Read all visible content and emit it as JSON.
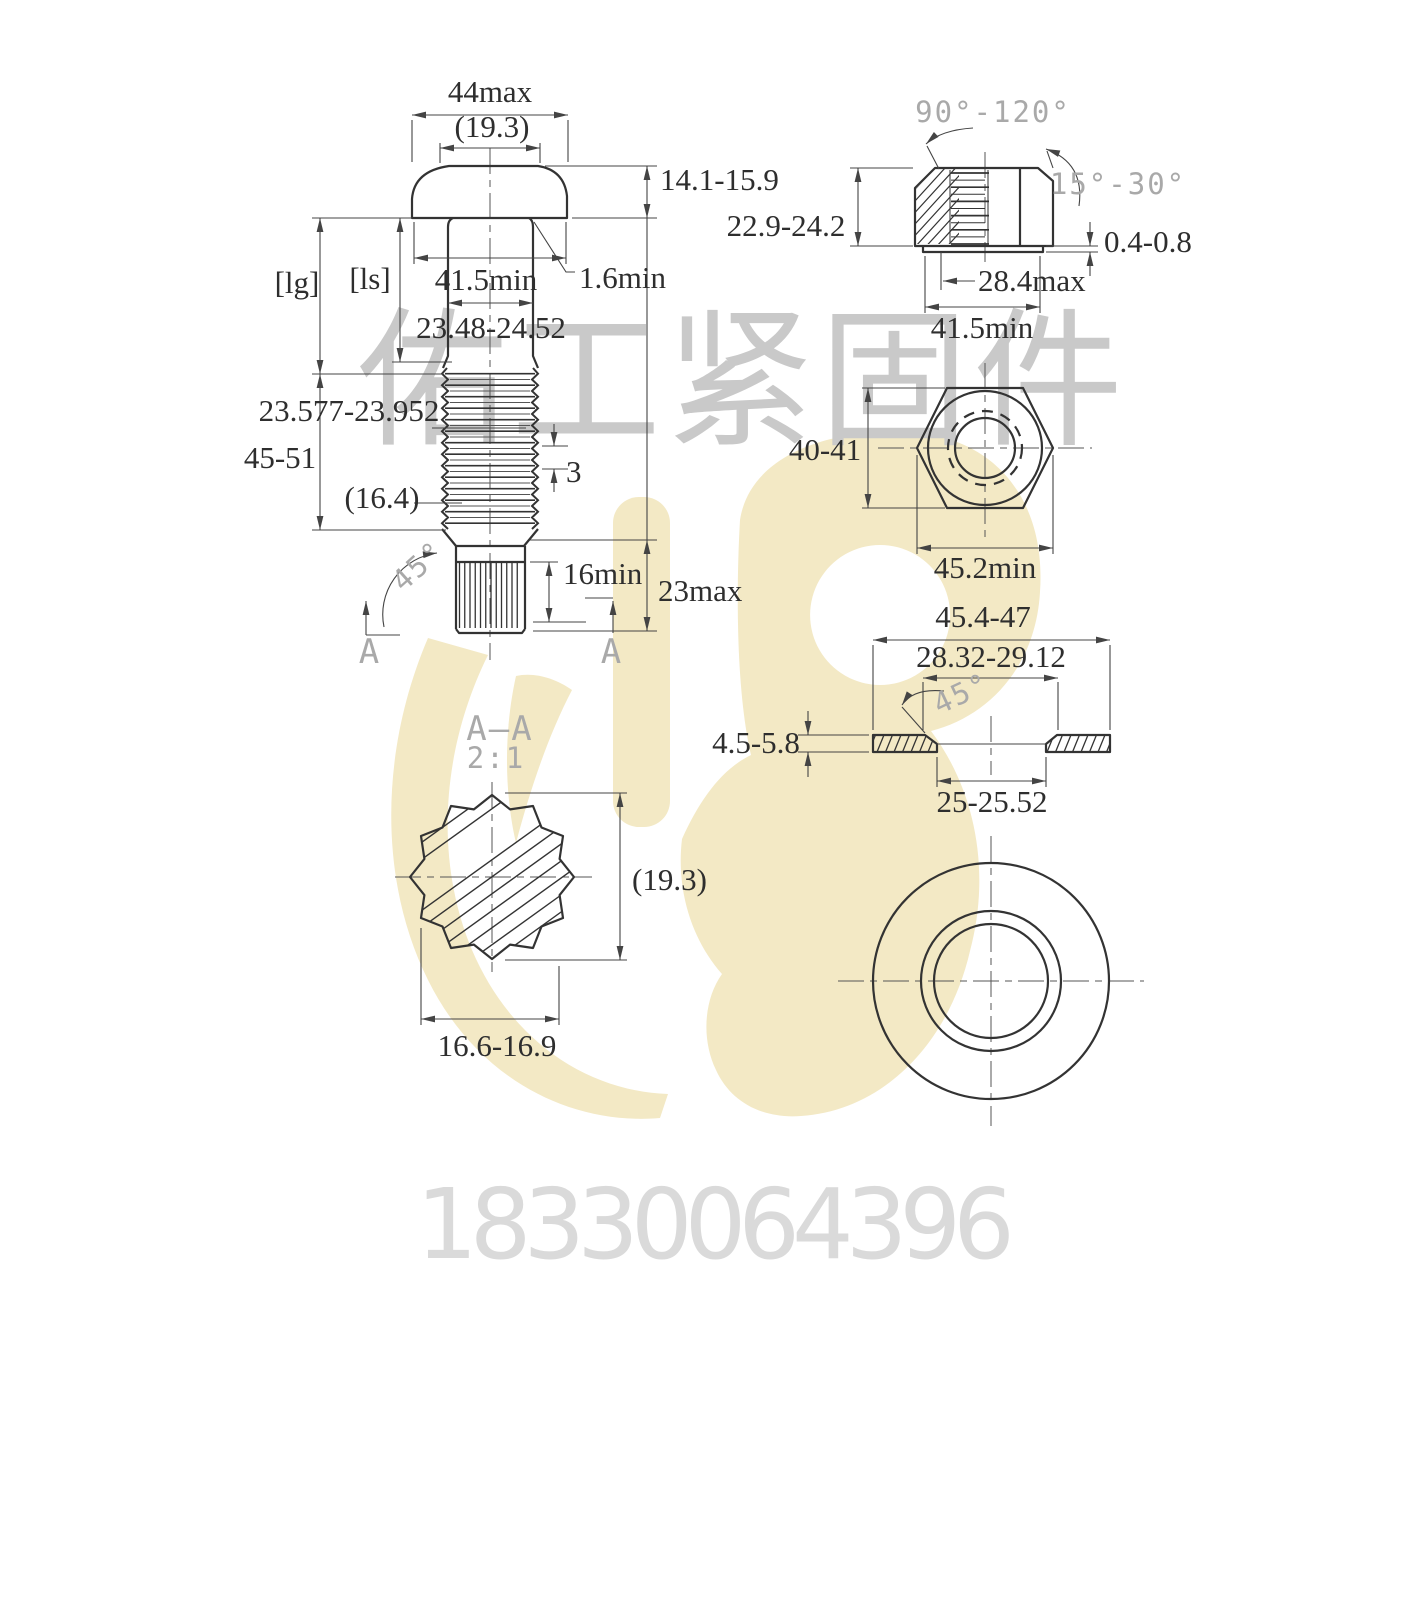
{
  "watermark": {
    "company": "佑工紧固件",
    "phone": "18330064396"
  },
  "colors": {
    "logo_yellow": "#f3e9c5",
    "watermark_text_gray": "#c9c9c9",
    "phone_gray": "#dadada",
    "drawing_line": "#333333",
    "cad_label_gray": "#a9a9a9"
  },
  "drawing": {
    "bolt_front_view": {
      "head_width": "44max",
      "head_ref_width": "(19.3)",
      "head_height": "14.1-15.9",
      "bearing_face_dia": "41.5min",
      "fillet_radius": "1.6min",
      "shank_dia": "23.48-24.52",
      "grip_length_label": "[lg]",
      "shank_length_label": "[ls]",
      "thread_dia": "23.577-23.952",
      "thread_length": "45-51",
      "thread_runout_ref": "(16.4)",
      "thread_pitch": "3",
      "chamfer_angle": "45°",
      "spline_length": "16min",
      "end_length": "23max",
      "section_letter": "A"
    },
    "section_view": {
      "title": "A—A",
      "scale_note": "2:1",
      "spline_dia_ref": "(19.3)",
      "across_flats": "16.6-16.9"
    },
    "nut_section_view": {
      "countersink_angle": "90°-120°",
      "chamfer_angle": "15°-30°",
      "height": "22.9-24.2",
      "washer_face_height": "0.4-0.8",
      "bore_dia": "28.4max",
      "bearing_face_dia": "41.5min"
    },
    "nut_face_view": {
      "across_flats": "40-41",
      "across_corners": "45.2min"
    },
    "washer_section_view": {
      "outer_dia": "45.4-47",
      "chamfer_dia": "28.32-29.12",
      "chamfer_angle": "45°",
      "thickness": "4.5-5.8",
      "bore_dia": "25-25.52"
    }
  }
}
